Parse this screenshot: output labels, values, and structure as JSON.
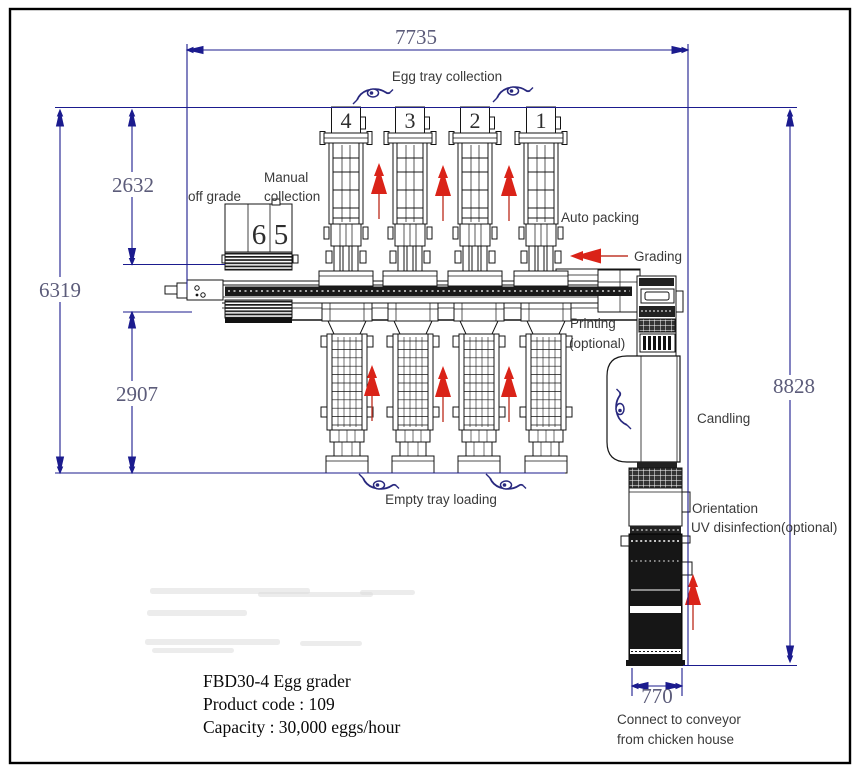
{
  "title": "FBD30-4 Egg grader layout drawing",
  "labels": {
    "egg_tray_collection": "Egg tray collection",
    "manual_collection_line1": "Manual",
    "manual_collection_line2": "collection",
    "off_grade": "off grade",
    "auto_packing": "Auto packing",
    "grading": "Grading",
    "printing_line1": "Printing",
    "printing_line2": "(optional)",
    "candling": "Candling",
    "orientation": "Orientation",
    "uv_disinfection": "UV disinfection(optional)",
    "empty_tray_loading": "Empty tray loading",
    "connect_line1": "Connect to conveyor",
    "connect_line2": "from chicken house"
  },
  "dimensions": {
    "overall_width": "7735",
    "upper_left_height": "2632",
    "left_total_height": "6319",
    "lower_left_height": "2907",
    "right_total_height": "8828",
    "conveyor_width": "770"
  },
  "lanes": {
    "top_numbers": [
      "4",
      "3",
      "2",
      "1"
    ],
    "off_grade_numbers": [
      "6",
      "5"
    ]
  },
  "info": {
    "model": "FBD30-4 Egg grader",
    "product_code": "Product code : 109",
    "capacity": "Capacity : 30,000 eggs/hour"
  },
  "colors": {
    "dimension_line": "#1b1b8e",
    "dimension_text": "#5c5c7a",
    "machine_line": "#141414",
    "flow_arrow_red": "#da2318",
    "eye_icon_navy": "#28287e",
    "label_text": "#3a3a3a"
  }
}
